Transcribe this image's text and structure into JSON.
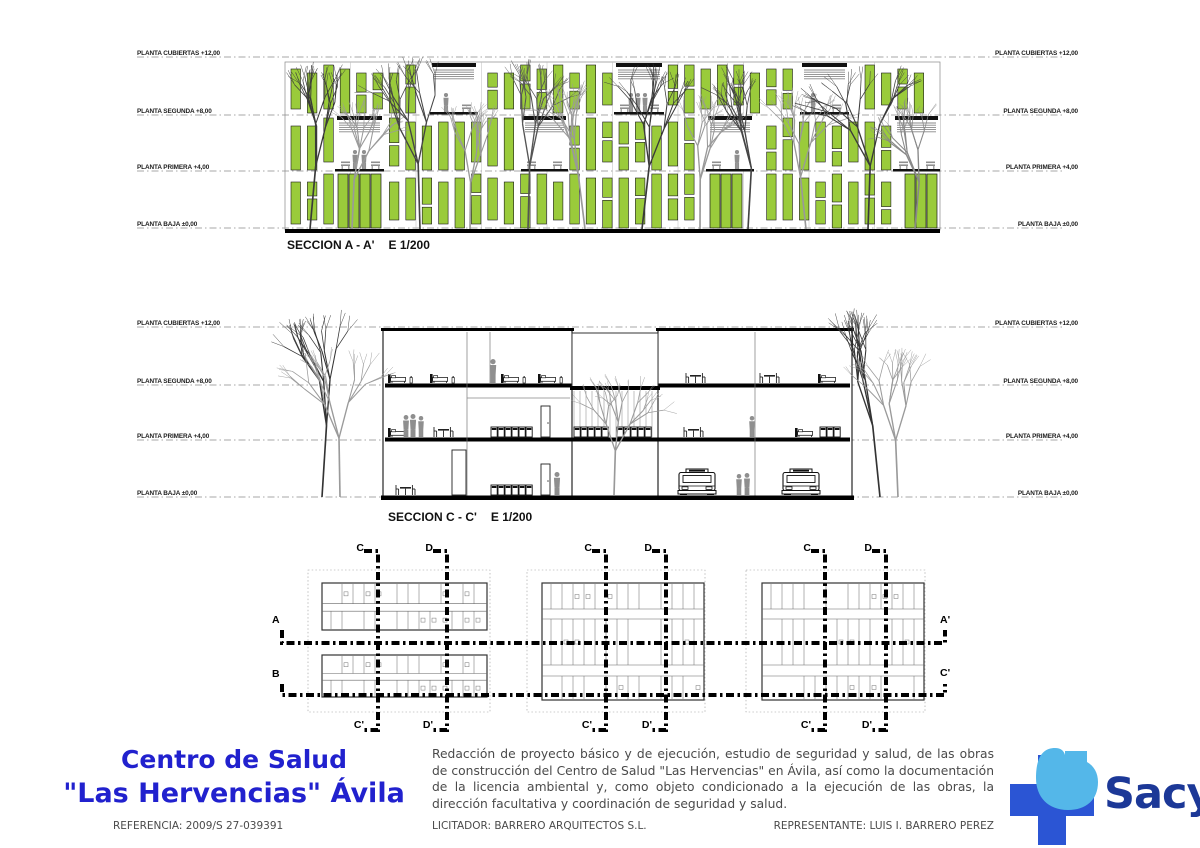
{
  "colors": {
    "facade_green": "#9acb3b",
    "panel_stroke": "#1b1b1b",
    "silhouette_gray": "#8f8f8f",
    "title_blue": "#2121ce",
    "text_gray": "#4a4a4a",
    "sacyl_cross_blue": "#2b55d4",
    "sacyl_light_blue": "#54b7e9",
    "sacyl_text_blue": "#1c3897"
  },
  "levels": [
    {
      "label": "PLANTA CUBIERTAS +12,00"
    },
    {
      "label": "PLANTA SEGUNDA +8,00"
    },
    {
      "label": "PLANTA PRIMERA +4,00"
    },
    {
      "label": "PLANTA BAJA ±0,00"
    }
  ],
  "sections": {
    "a": {
      "title": "SECCION A - A'",
      "scale": "E 1/200"
    },
    "c": {
      "title": "SECCION C - C'",
      "scale": "E 1/200"
    }
  },
  "plans": {
    "labels": {
      "a": "A",
      "b": "B",
      "a_prime": "A'",
      "c_prime_right": "C'",
      "c": "C",
      "d": "D",
      "c_prime": "C'",
      "d_prime": "D'"
    }
  },
  "titleblock": {
    "project_line1": "Centro de Salud",
    "project_line2": "\"Las Hervencias\" Ávila",
    "reference": "REFERENCIA: 2009/S 27-039391",
    "description": "Redacción de proyecto básico y de ejecución, estudio de seguridad y salud, de las obras de construcción del Centro de Salud \"Las Hervencias\" en Ávila, así como la documentación de la licencia ambiental y, como objeto condicionado a la ejecución de las obras, la dirección facultativa y coordinación de seguridad y salud.",
    "licitador": "LICITADOR: BARRERO ARQUITECTOS S.L.",
    "representante": "REPRESENTANTE: LUIS I. BARRERO PEREZ",
    "logo_text": "Sacyl"
  }
}
